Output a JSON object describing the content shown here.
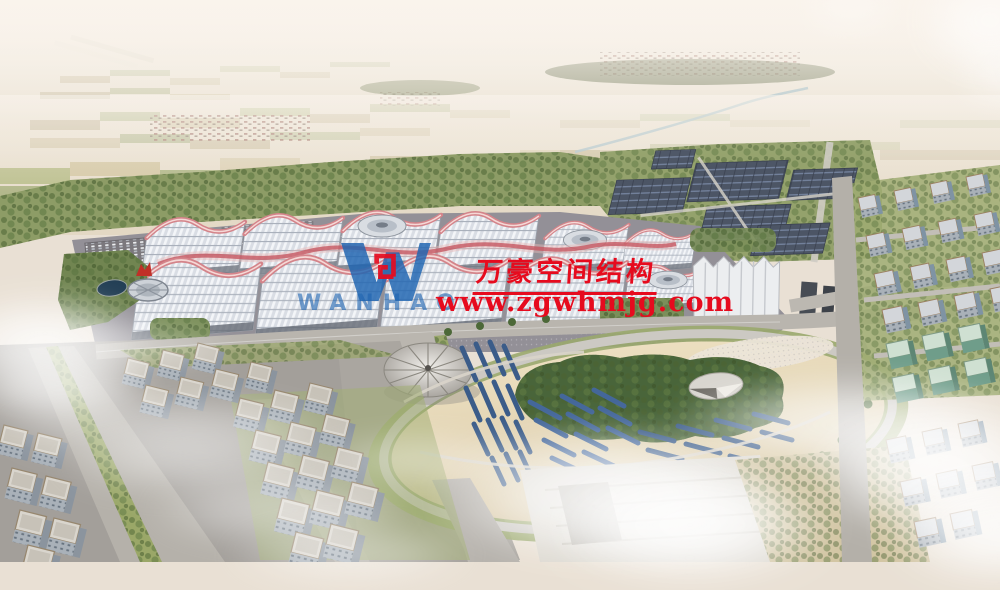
{
  "watermark": {
    "company_name": "万豪空间结构",
    "website": "www.zgwhmjg.com",
    "logo_text": "WANHAO"
  },
  "colors": {
    "watermark_red": "#e60b1e",
    "logo_blue": "#2065b1"
  }
}
